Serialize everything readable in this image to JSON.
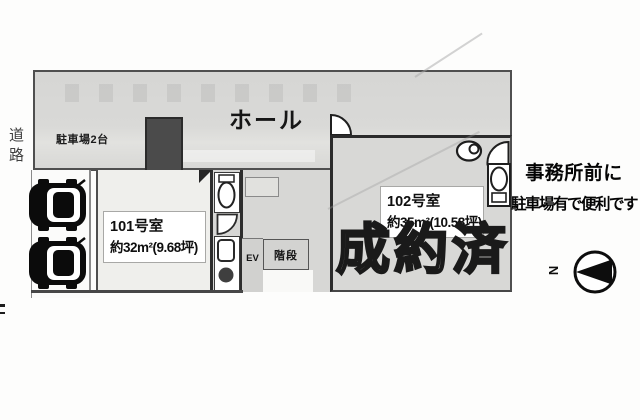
{
  "plan": {
    "road": "道路",
    "parking_area": "駐車場2台",
    "hall": "ホール",
    "rooms": [
      {
        "id": "101",
        "name": "101号室",
        "area": "約32m²(9.68坪)"
      },
      {
        "id": "102",
        "name": "102号室",
        "area": "約35m²(10.58坪)",
        "status": "成約済"
      }
    ],
    "elevator": "EV",
    "stairs": "階段",
    "sold_stamp": "成約済",
    "compass_letter": "N"
  },
  "note": {
    "line1": "事務所前に",
    "line2": "駐車場有で便利です"
  },
  "icons": {
    "arrow": "down-arrow-icon",
    "car": "car-top-view-icon",
    "toilet": "toilet-icon",
    "sink": "sink-icon",
    "washer": "washing-machine-icon",
    "door": "door-swing-icon",
    "compass": "compass-icon"
  },
  "colors": {
    "plan_gray": "#d8d8d6",
    "wall": "#2d2d2d",
    "outer_border": "#4f4f4f",
    "arrow": "#4b4b4b",
    "sold_fill": "#d3d3d1",
    "sold_outline": "#1a1a1a",
    "car": "#0b0b0b",
    "text": "#111111"
  }
}
